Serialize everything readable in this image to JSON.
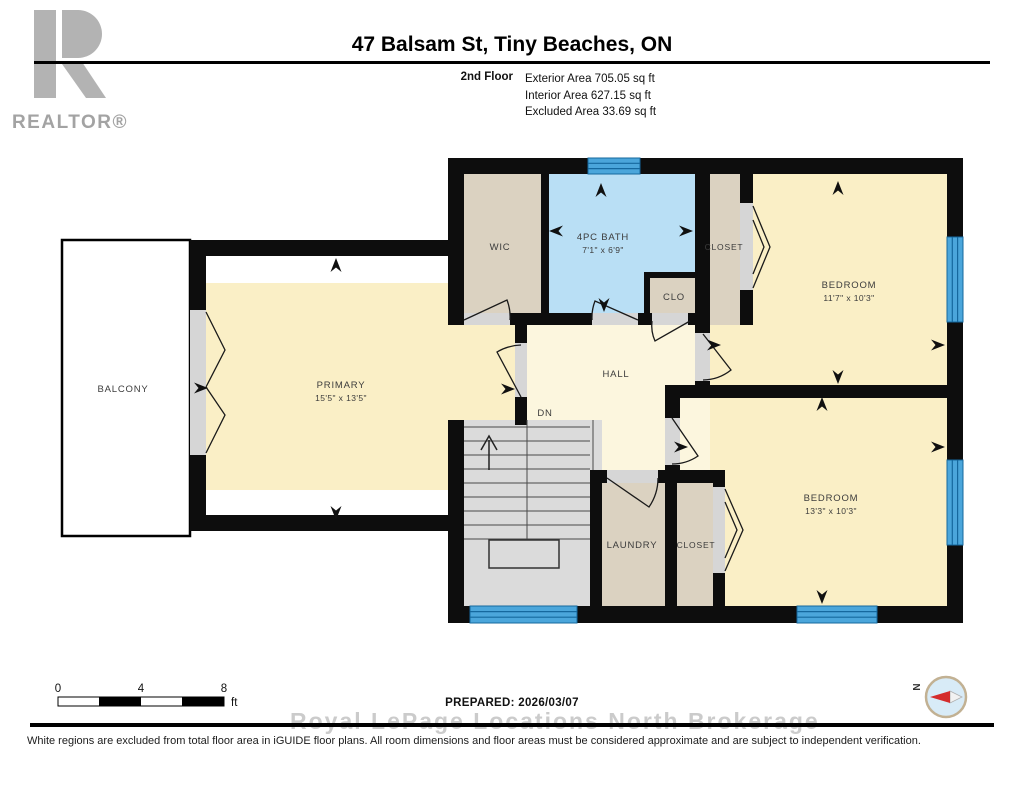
{
  "header": {
    "logo_text": "REALTOR®",
    "title": "47 Balsam St, Tiny Beaches, ON",
    "floor_label": "2nd Floor",
    "areas": [
      "Exterior Area 705.05 sq ft",
      "Interior Area 627.15 sq ft",
      "Excluded Area 33.69 sq ft"
    ]
  },
  "floor_plan": {
    "rooms": [
      {
        "id": "balcony",
        "label": "BALCONY",
        "dimensions": ""
      },
      {
        "id": "primary",
        "label": "PRIMARY",
        "dimensions": "15'5\" x 13'5\""
      },
      {
        "id": "wic",
        "label": "WIC",
        "dimensions": ""
      },
      {
        "id": "bath",
        "label": "4PC BATH",
        "dimensions": "7'1\" x 6'9\""
      },
      {
        "id": "clo",
        "label": "CLO",
        "dimensions": ""
      },
      {
        "id": "closet-upper",
        "label": "CLOSET",
        "dimensions": ""
      },
      {
        "id": "bedroom-upper",
        "label": "BEDROOM",
        "dimensions": "11'7\" x 10'3\""
      },
      {
        "id": "hall",
        "label": "HALL",
        "dimensions": ""
      },
      {
        "id": "stairs-down",
        "label": "DN",
        "dimensions": ""
      },
      {
        "id": "laundry",
        "label": "LAUNDRY",
        "dimensions": ""
      },
      {
        "id": "closet-lower",
        "label": "CLOSET",
        "dimensions": ""
      },
      {
        "id": "bedroom-lower",
        "label": "BEDROOM",
        "dimensions": "13'3\" x 10'3\""
      }
    ]
  },
  "footer": {
    "scale_bar": {
      "start": "0",
      "mid": "4",
      "end": "8",
      "unit": "ft"
    },
    "prepared": "PREPARED: 2026/03/07",
    "compass_north_label": "N",
    "watermark": "Royal LePage Locations North  Brokerage",
    "disclaimer": "White regions are excluded from total floor area in iGUIDE floor plans. All room dimensions and floor areas must be considered approximate and are subject to independent verification."
  },
  "colors": {
    "wall": "#0d0d0d",
    "room_fill": "#FAEFC6",
    "hall_fill": "#FCF6DE",
    "closet_fill": "#DBD2C1",
    "bath_fill": "#B9DFF5",
    "stairs_fill": "#DBDBDB",
    "window_blue": "#4BA6DB",
    "window_frame": "#15689E",
    "logo_gray": "#B3B3B3",
    "compass_red": "#D42C2C"
  }
}
